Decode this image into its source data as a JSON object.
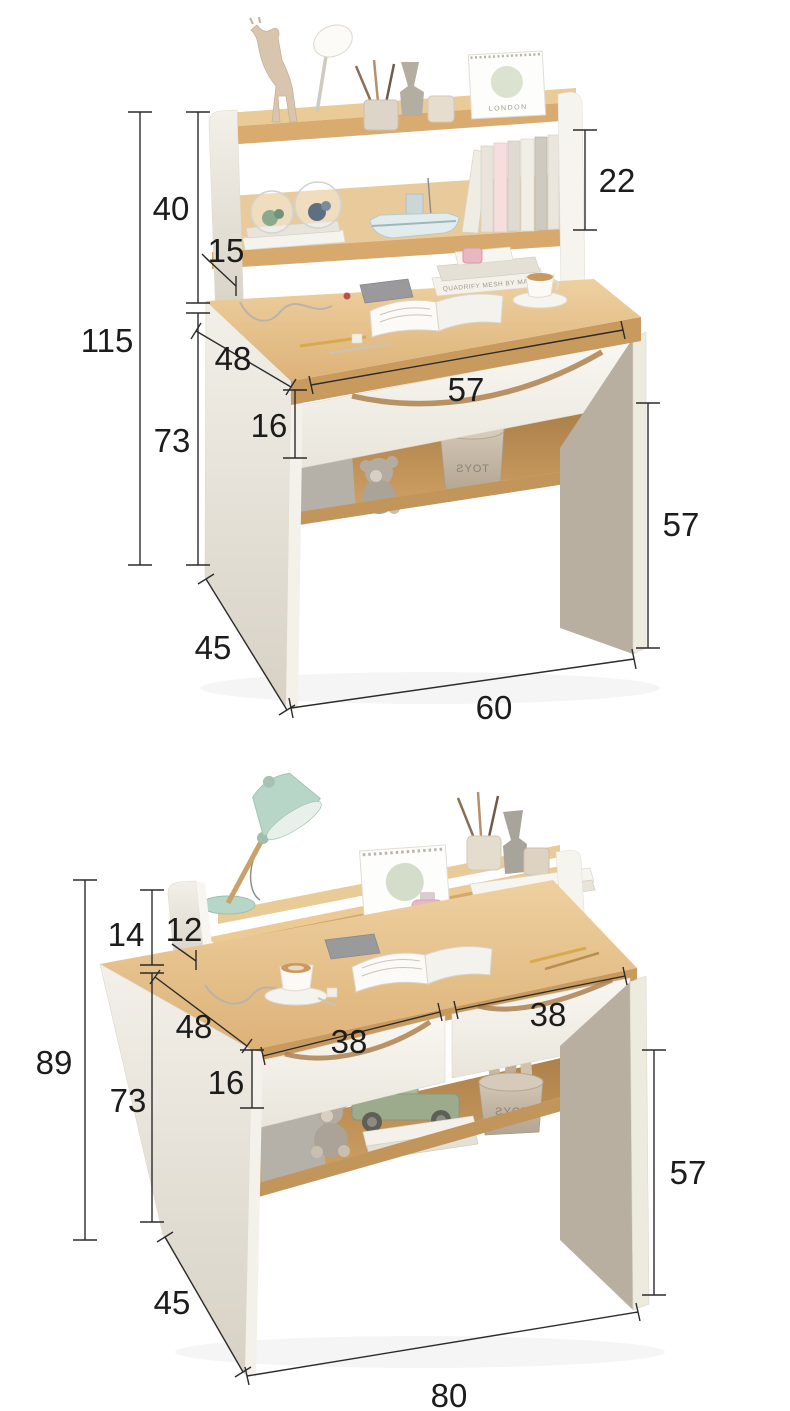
{
  "page": {
    "background": "#ffffff"
  },
  "colors": {
    "wood_light": "#eed0a0",
    "wood_mid": "#ddb278",
    "wood_edge": "#c89a5e",
    "cavity_dark": "#a97d48",
    "panel_white": "#f6f4ee",
    "panel_shadow": "#d7d1c5",
    "leg_grey": "#b9afa1",
    "dim_line": "#2b2b2b",
    "dim_text": "#1c1c1c",
    "lamp_mint": "#b7d6c8",
    "accent_pink": "#e8b7c2",
    "toy_green": "#9dab8d"
  },
  "figure1": {
    "dims": {
      "total_height": "115",
      "hutch_height": "40",
      "hutch_shelf_depth": "15",
      "shelf_opening_height": "22",
      "desk_height": "73",
      "desktop_depth": "48",
      "drawer_width": "57",
      "drawer_height": "16",
      "under_desk_clearance": "57",
      "depth": "45",
      "width": "60"
    },
    "decor": {
      "calendar_text": "LONDON",
      "book_spine_text": "QUADRIFY MESH BY MAX",
      "basket_text": "TOYS"
    }
  },
  "figure2": {
    "dims": {
      "total_height": "89",
      "riser_height": "14",
      "riser_depth": "12",
      "desk_height": "73",
      "desktop_depth": "48",
      "drawer_height": "16",
      "drawer_left_width": "38",
      "drawer_right_width": "38",
      "under_desk_clearance": "57",
      "depth": "45",
      "width": "80"
    },
    "decor": {
      "calendar_text": "LONDON",
      "book_spine_text": "QUADRIFY MESH BY MAX",
      "basket_text": "TOYS"
    }
  }
}
